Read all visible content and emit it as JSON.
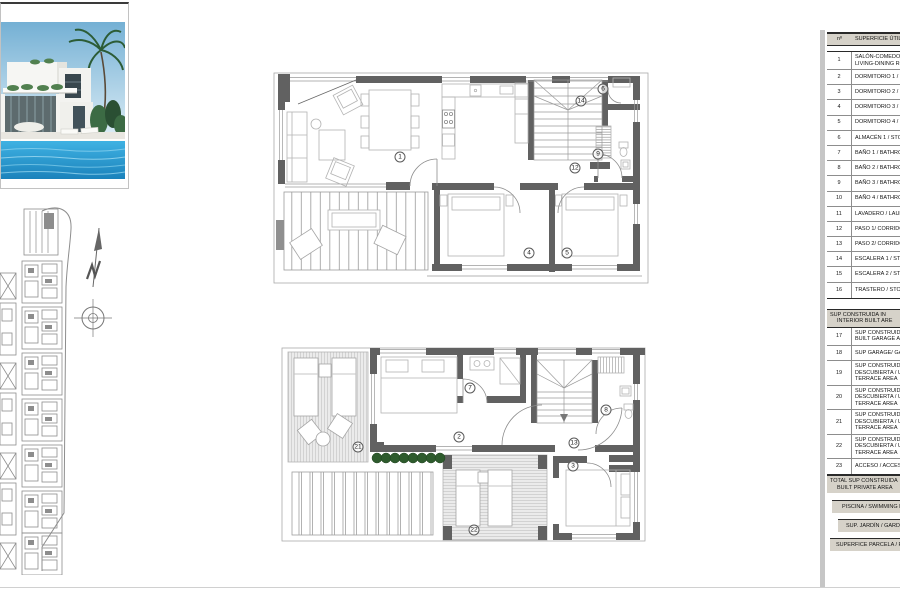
{
  "colors": {
    "wall_gray": "#616161",
    "furniture_gray": "#b3b3b3",
    "bush_green": "#2e5b2d",
    "table_band_bg": "#d6d2c9",
    "sheet_edge_gray": "#c6c6c6",
    "pool_blue": "#2f9fd6",
    "sky_blue": "#74b0d4"
  },
  "photo": {
    "label": "villa-exterior-render"
  },
  "site_plan": {
    "label": "site-plan-with-north-arrow"
  },
  "floor_markers": {
    "upper": [
      {
        "n": "1",
        "x": 400,
        "y": 157
      },
      {
        "n": "4",
        "x": 529,
        "y": 253
      },
      {
        "n": "5",
        "x": 567,
        "y": 253
      },
      {
        "n": "6",
        "x": 603,
        "y": 89
      },
      {
        "n": "9",
        "x": 598,
        "y": 154
      },
      {
        "n": "12",
        "x": 575,
        "y": 168
      },
      {
        "n": "14",
        "x": 581,
        "y": 101
      }
    ],
    "ground": [
      {
        "n": "21",
        "x": 358,
        "y": 447
      },
      {
        "n": "2",
        "x": 459,
        "y": 437
      },
      {
        "n": "7",
        "x": 470,
        "y": 388
      },
      {
        "n": "8",
        "x": 606,
        "y": 410
      },
      {
        "n": "13",
        "x": 574,
        "y": 443
      },
      {
        "n": "3",
        "x": 573,
        "y": 466
      },
      {
        "n": "22",
        "x": 474,
        "y": 530
      }
    ]
  },
  "area_table": {
    "header": {
      "no": "nº",
      "label": "SUPERFICIE ÚTIL / USEFUL"
    },
    "rows": [
      {
        "no": "1",
        "label": [
          "SALÓN-COMEDOR /",
          "LIVING-DINING RO"
        ]
      },
      {
        "no": "2",
        "label": [
          "DORMITORIO 1 / B"
        ]
      },
      {
        "no": "3",
        "label": [
          "DORMITORIO 2 / B"
        ]
      },
      {
        "no": "4",
        "label": [
          "DORMITORIO 3 / B"
        ]
      },
      {
        "no": "5",
        "label": [
          "DORMITORIO 4 / B"
        ]
      },
      {
        "no": "6",
        "label": [
          "ALMACÉN 1 / STOR"
        ]
      },
      {
        "no": "7",
        "label": [
          "BAÑO 1 / BATHRO"
        ]
      },
      {
        "no": "8",
        "label": [
          "BAÑO 2 / BATHRO"
        ]
      },
      {
        "no": "9",
        "label": [
          "BAÑO 3 / BATHRO"
        ]
      },
      {
        "no": "10",
        "label": [
          "BAÑO 4 / BATHRO"
        ]
      },
      {
        "no": "11",
        "label": [
          "LAVADERO / LAUN"
        ]
      },
      {
        "no": "12",
        "label": [
          "PASO 1/ CORRIDO"
        ]
      },
      {
        "no": "13",
        "label": [
          "PASO 2/ CORRIDO"
        ]
      },
      {
        "no": "14",
        "label": [
          "ESCALERA 1 / STAI"
        ]
      },
      {
        "no": "15",
        "label": [
          "ESCALERA 2 / STAI"
        ]
      },
      {
        "no": "16",
        "label": [
          "TRASTERO / STOR"
        ]
      }
    ],
    "section2": [
      "SUP CONSTRUIDA IN",
      "INTERIOR BUILT ARE"
    ],
    "rows2": [
      {
        "no": "17",
        "label": [
          "SUP CONSTRUIDA",
          "BUILT GARAGE AR"
        ]
      },
      {
        "no": "18",
        "label": [
          "SUP GARAGE/ GAR"
        ]
      },
      {
        "no": "19",
        "label": [
          "SUP CONSTRUIDA",
          "DESCUBIERTA / U",
          "TERRACE AREA"
        ]
      },
      {
        "no": "20",
        "label": [
          "SUP CONSTRUIDA",
          "DESCUBIERTA / U",
          "TERRACE AREA"
        ]
      },
      {
        "no": "21",
        "label": [
          "SUP CONSTRUIDA",
          "DESCUBIERTA / U",
          "TERRACE AREA"
        ]
      },
      {
        "no": "22",
        "label": [
          "SUP CONSTRUIDA",
          "DESCUBIERTA / U",
          "TERRACE AREA"
        ]
      },
      {
        "no": "23",
        "label": [
          "ACCESO / ACCESS"
        ]
      }
    ],
    "total": [
      "TOTAL SUP CONSTRUIDA",
      "BUILT PRIVATE AREA"
    ],
    "bands": [
      "PISCINA / SWIMMING POOL",
      "SUP. JARDÍN / GARDEN AREA",
      "SUPERFICE PARCELA / PLOT"
    ]
  }
}
